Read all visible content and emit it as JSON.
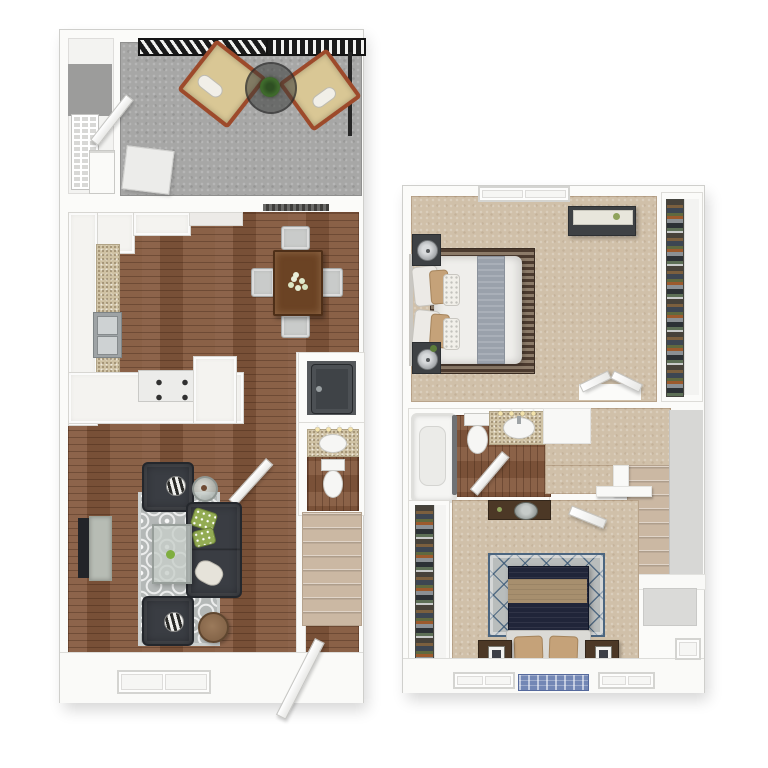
{
  "scene": {
    "type": "3d-floor-plan-rendering",
    "description": "Two-level townhouse floor plan, top-down 3D view, two plans side by side",
    "floors": [
      {
        "id": "first-floor",
        "rooms": [
          {
            "name": "patio",
            "items": [
              "privacy-railing",
              "lounge-chair",
              "lounge-chair",
              "round-glass-table",
              "potted-plant",
              "patio-door",
              "equipment-pad"
            ]
          },
          {
            "name": "storage-closet",
            "items": [
              "wire-shelving",
              "water-heater"
            ]
          },
          {
            "name": "kitchen",
            "items": [
              "upper-cabinets",
              "base-cabinets",
              "speckled-countertop",
              "double-sink",
              "range-stove",
              "peninsula-counter"
            ]
          },
          {
            "name": "dining-area",
            "items": [
              "dining-table",
              "dining-chair",
              "dining-chair",
              "dining-chair",
              "dining-chair",
              "flower-centerpiece",
              "wall-vent"
            ]
          },
          {
            "name": "living-room",
            "items": [
              "sectional-sofa",
              "armchair",
              "armchair",
              "quatrefoil-area-rug",
              "glass-coffee-table",
              "tv-console",
              "television",
              "glass-side-table",
              "round-side-table",
              "zebra-pillow",
              "green-pillows",
              "white-pillow"
            ]
          },
          {
            "name": "utility-closet",
            "items": [
              "washer-dryer-appliance"
            ]
          },
          {
            "name": "half-bathroom",
            "items": [
              "vanity-sink",
              "vanity-lights",
              "toilet",
              "door"
            ]
          },
          {
            "name": "staircase",
            "items": [
              "carpeted-steps"
            ]
          },
          {
            "name": "entry",
            "items": [
              "front-door",
              "double-window"
            ]
          }
        ]
      },
      {
        "id": "second-floor",
        "rooms": [
          {
            "name": "master-bedroom",
            "items": [
              "bed",
              "striped-rug",
              "nightstand",
              "nightstand",
              "lamp",
              "lamp",
              "dresser",
              "double-doors",
              "window"
            ]
          },
          {
            "name": "walk-in-closet",
            "items": [
              "hanging-clothes"
            ]
          },
          {
            "name": "bathroom",
            "items": [
              "bathtub",
              "shower-curtain",
              "toilet",
              "vanity-sink",
              "vanity-lights",
              "door"
            ]
          },
          {
            "name": "hallway",
            "items": [
              "staircase",
              "half-wall-railing",
              "newel-post",
              "linen-door"
            ]
          },
          {
            "name": "bedroom-2",
            "items": [
              "bed",
              "lattice-rug",
              "nightstand",
              "nightstand",
              "picture-frame",
              "picture-frame",
              "dresser",
              "basket",
              "blue-mat",
              "windows",
              "door"
            ]
          },
          {
            "name": "closet-2",
            "items": [
              "hanging-clothes"
            ]
          }
        ]
      }
    ]
  },
  "colors": {
    "canvas": "#ffffff",
    "wall": "#fbfbf9",
    "wall_edge": "#cfcfcc",
    "wood_floor": "#84583d",
    "patio_concrete": "#a7a7a6",
    "railing": "#1a1a1a",
    "lounge_cushion": "#d9c795",
    "lounge_frame": "#9d4a2b",
    "plant_green": "#3f6b2c",
    "counter_tan": "#cfc2a4",
    "cabinet_white": "#f4f3f0",
    "steel": "#b9bec0",
    "utility_floor": "#55585b",
    "appliance_gray": "#3f4347",
    "porcelain": "#f6f6f4",
    "vanity_light": "#f3e3ac",
    "sofa_charcoal": "#3a3d43",
    "rug_gray": "#b4b8b7",
    "pillow_green": "#93ac53",
    "zebra_dark": "#2a2a28",
    "table_wood": "#6b4324",
    "chair_gray": "#c9cbca",
    "carpet_beige": "#d0c0a9",
    "stair_carpet": "#cbb8a3",
    "bed_white": "#efeeeb",
    "bed_runner": "#9aa1ab",
    "rug1_stripe_dark": "#4c3b2f",
    "rug1_stripe_light": "#8c7b69",
    "pillow_tan": "#c5a279",
    "furniture_dark": "#3e4144",
    "clothes_1": "#47423a",
    "clothes_2": "#7b5f3e",
    "clothes_3": "#3d4652",
    "clothes_4": "#60693f",
    "clothes_5": "#9c5a2d",
    "clothes_6": "#8b9094",
    "bed2_navy": "#202539",
    "bed2_stripe": "#a78f6e",
    "bed2_head": "#dbdad6",
    "rug2_gray": "#b9bdbc",
    "rug2_line": "#4c6680",
    "wood_dark": "#4c3826",
    "mat_blue": "#7387b5"
  }
}
